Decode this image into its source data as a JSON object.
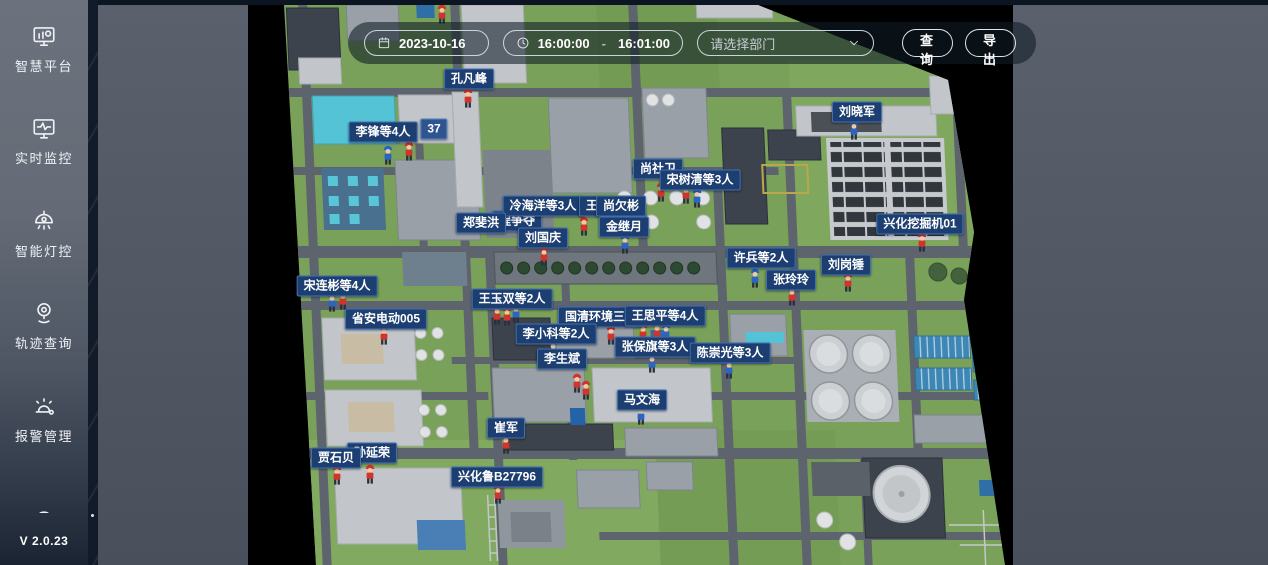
{
  "sidebar": {
    "items": [
      {
        "id": "smart-platform",
        "label": "智慧平台"
      },
      {
        "id": "realtime-monitor",
        "label": "实时监控"
      },
      {
        "id": "smart-light-control",
        "label": "智能灯控"
      },
      {
        "id": "trajectory-query",
        "label": "轨迹查询"
      },
      {
        "id": "alarm-management",
        "label": "报警管理"
      }
    ],
    "version": "V 2.0.23"
  },
  "toolbar": {
    "date": "2023-10-16",
    "time_start": "16:00:00",
    "time_separator": "-",
    "time_end": "16:01:00",
    "department_placeholder": "请选择部门",
    "query_label": "查询",
    "export_label": "导出"
  },
  "map": {
    "colors": {
      "label_bg": "#1d3e70",
      "label_border": "#4272b4",
      "marker_red": "#d0342c",
      "marker_blue": "#2a64c5"
    },
    "labels": [
      {
        "text": "孔凡峰",
        "x": 469,
        "y": 79
      },
      {
        "text": "37",
        "x": 434,
        "y": 129,
        "variant": "light"
      },
      {
        "text": "李锋等4人",
        "x": 383,
        "y": 132
      },
      {
        "text": "刘晓军",
        "x": 857,
        "y": 112
      },
      {
        "text": "尚社卫",
        "x": 658,
        "y": 169
      },
      {
        "text": "宋树清等3人",
        "x": 700,
        "y": 180
      },
      {
        "text": "程争夺",
        "x": 517,
        "y": 221
      },
      {
        "text": "冷海洋等3人",
        "x": 543,
        "y": 206
      },
      {
        "text": "王文",
        "x": 598,
        "y": 206
      },
      {
        "text": "尚欠彬",
        "x": 621,
        "y": 206
      },
      {
        "text": "郑斐洪",
        "x": 481,
        "y": 223
      },
      {
        "text": "金继月",
        "x": 624,
        "y": 227
      },
      {
        "text": "刘国庆",
        "x": 543,
        "y": 238
      },
      {
        "text": "兴化挖掘机01",
        "x": 920,
        "y": 224
      },
      {
        "text": "许兵等2人",
        "x": 761,
        "y": 258
      },
      {
        "text": "刘岗锤",
        "x": 846,
        "y": 265
      },
      {
        "text": "张玲玲",
        "x": 791,
        "y": 280
      },
      {
        "text": "宋连彬等4人",
        "x": 337,
        "y": 286
      },
      {
        "text": "王玉双等2人",
        "x": 512,
        "y": 299
      },
      {
        "text": "省安电动005",
        "x": 386,
        "y": 319
      },
      {
        "text": "国清环境三轮",
        "x": 601,
        "y": 317
      },
      {
        "text": "王思平等4人",
        "x": 665,
        "y": 316
      },
      {
        "text": "李小科等2人",
        "x": 556,
        "y": 334
      },
      {
        "text": "张保旗等3人",
        "x": 655,
        "y": 347
      },
      {
        "text": "陈崇光等3人",
        "x": 730,
        "y": 353
      },
      {
        "text": "李生斌",
        "x": 562,
        "y": 359
      },
      {
        "text": "马文海",
        "x": 642,
        "y": 400
      },
      {
        "text": "崔军",
        "x": 506,
        "y": 428
      },
      {
        "text": "孙延荣",
        "x": 372,
        "y": 453
      },
      {
        "text": "贾石贝",
        "x": 336,
        "y": 458
      },
      {
        "text": "兴化鲁B27796",
        "x": 497,
        "y": 477
      }
    ],
    "markers": [
      {
        "x": 442,
        "y": 4,
        "color": "red"
      },
      {
        "x": 468,
        "y": 88,
        "color": "red"
      },
      {
        "x": 388,
        "y": 145,
        "color": "blue"
      },
      {
        "x": 409,
        "y": 141,
        "color": "red"
      },
      {
        "x": 854,
        "y": 120,
        "color": "blue"
      },
      {
        "x": 661,
        "y": 182,
        "color": "red"
      },
      {
        "x": 686,
        "y": 184,
        "color": "red"
      },
      {
        "x": 697,
        "y": 188,
        "color": "blue"
      },
      {
        "x": 584,
        "y": 216,
        "color": "red"
      },
      {
        "x": 610,
        "y": 214,
        "color": "red"
      },
      {
        "x": 625,
        "y": 234,
        "color": "blue"
      },
      {
        "x": 544,
        "y": 246,
        "color": "red"
      },
      {
        "x": 922,
        "y": 232,
        "color": "red"
      },
      {
        "x": 755,
        "y": 268,
        "color": "blue"
      },
      {
        "x": 792,
        "y": 286,
        "color": "red"
      },
      {
        "x": 848,
        "y": 272,
        "color": "red"
      },
      {
        "x": 332,
        "y": 292,
        "color": "blue"
      },
      {
        "x": 343,
        "y": 290,
        "color": "red"
      },
      {
        "x": 384,
        "y": 325,
        "color": "red"
      },
      {
        "x": 497,
        "y": 305,
        "color": "red"
      },
      {
        "x": 507,
        "y": 306,
        "color": "red"
      },
      {
        "x": 516,
        "y": 303,
        "color": "blue"
      },
      {
        "x": 611,
        "y": 325,
        "color": "red"
      },
      {
        "x": 643,
        "y": 323,
        "color": "red"
      },
      {
        "x": 657,
        "y": 322,
        "color": "red"
      },
      {
        "x": 666,
        "y": 323,
        "color": "blue"
      },
      {
        "x": 652,
        "y": 353,
        "color": "blue"
      },
      {
        "x": 729,
        "y": 359,
        "color": "blue"
      },
      {
        "x": 553,
        "y": 340,
        "color": "blue"
      },
      {
        "x": 577,
        "y": 373,
        "color": "red"
      },
      {
        "x": 586,
        "y": 380,
        "color": "red"
      },
      {
        "x": 641,
        "y": 405,
        "color": "blue"
      },
      {
        "x": 506,
        "y": 434,
        "color": "red"
      },
      {
        "x": 337,
        "y": 465,
        "color": "red"
      },
      {
        "x": 370,
        "y": 464,
        "color": "red"
      },
      {
        "x": 498,
        "y": 484,
        "color": "red"
      }
    ]
  }
}
